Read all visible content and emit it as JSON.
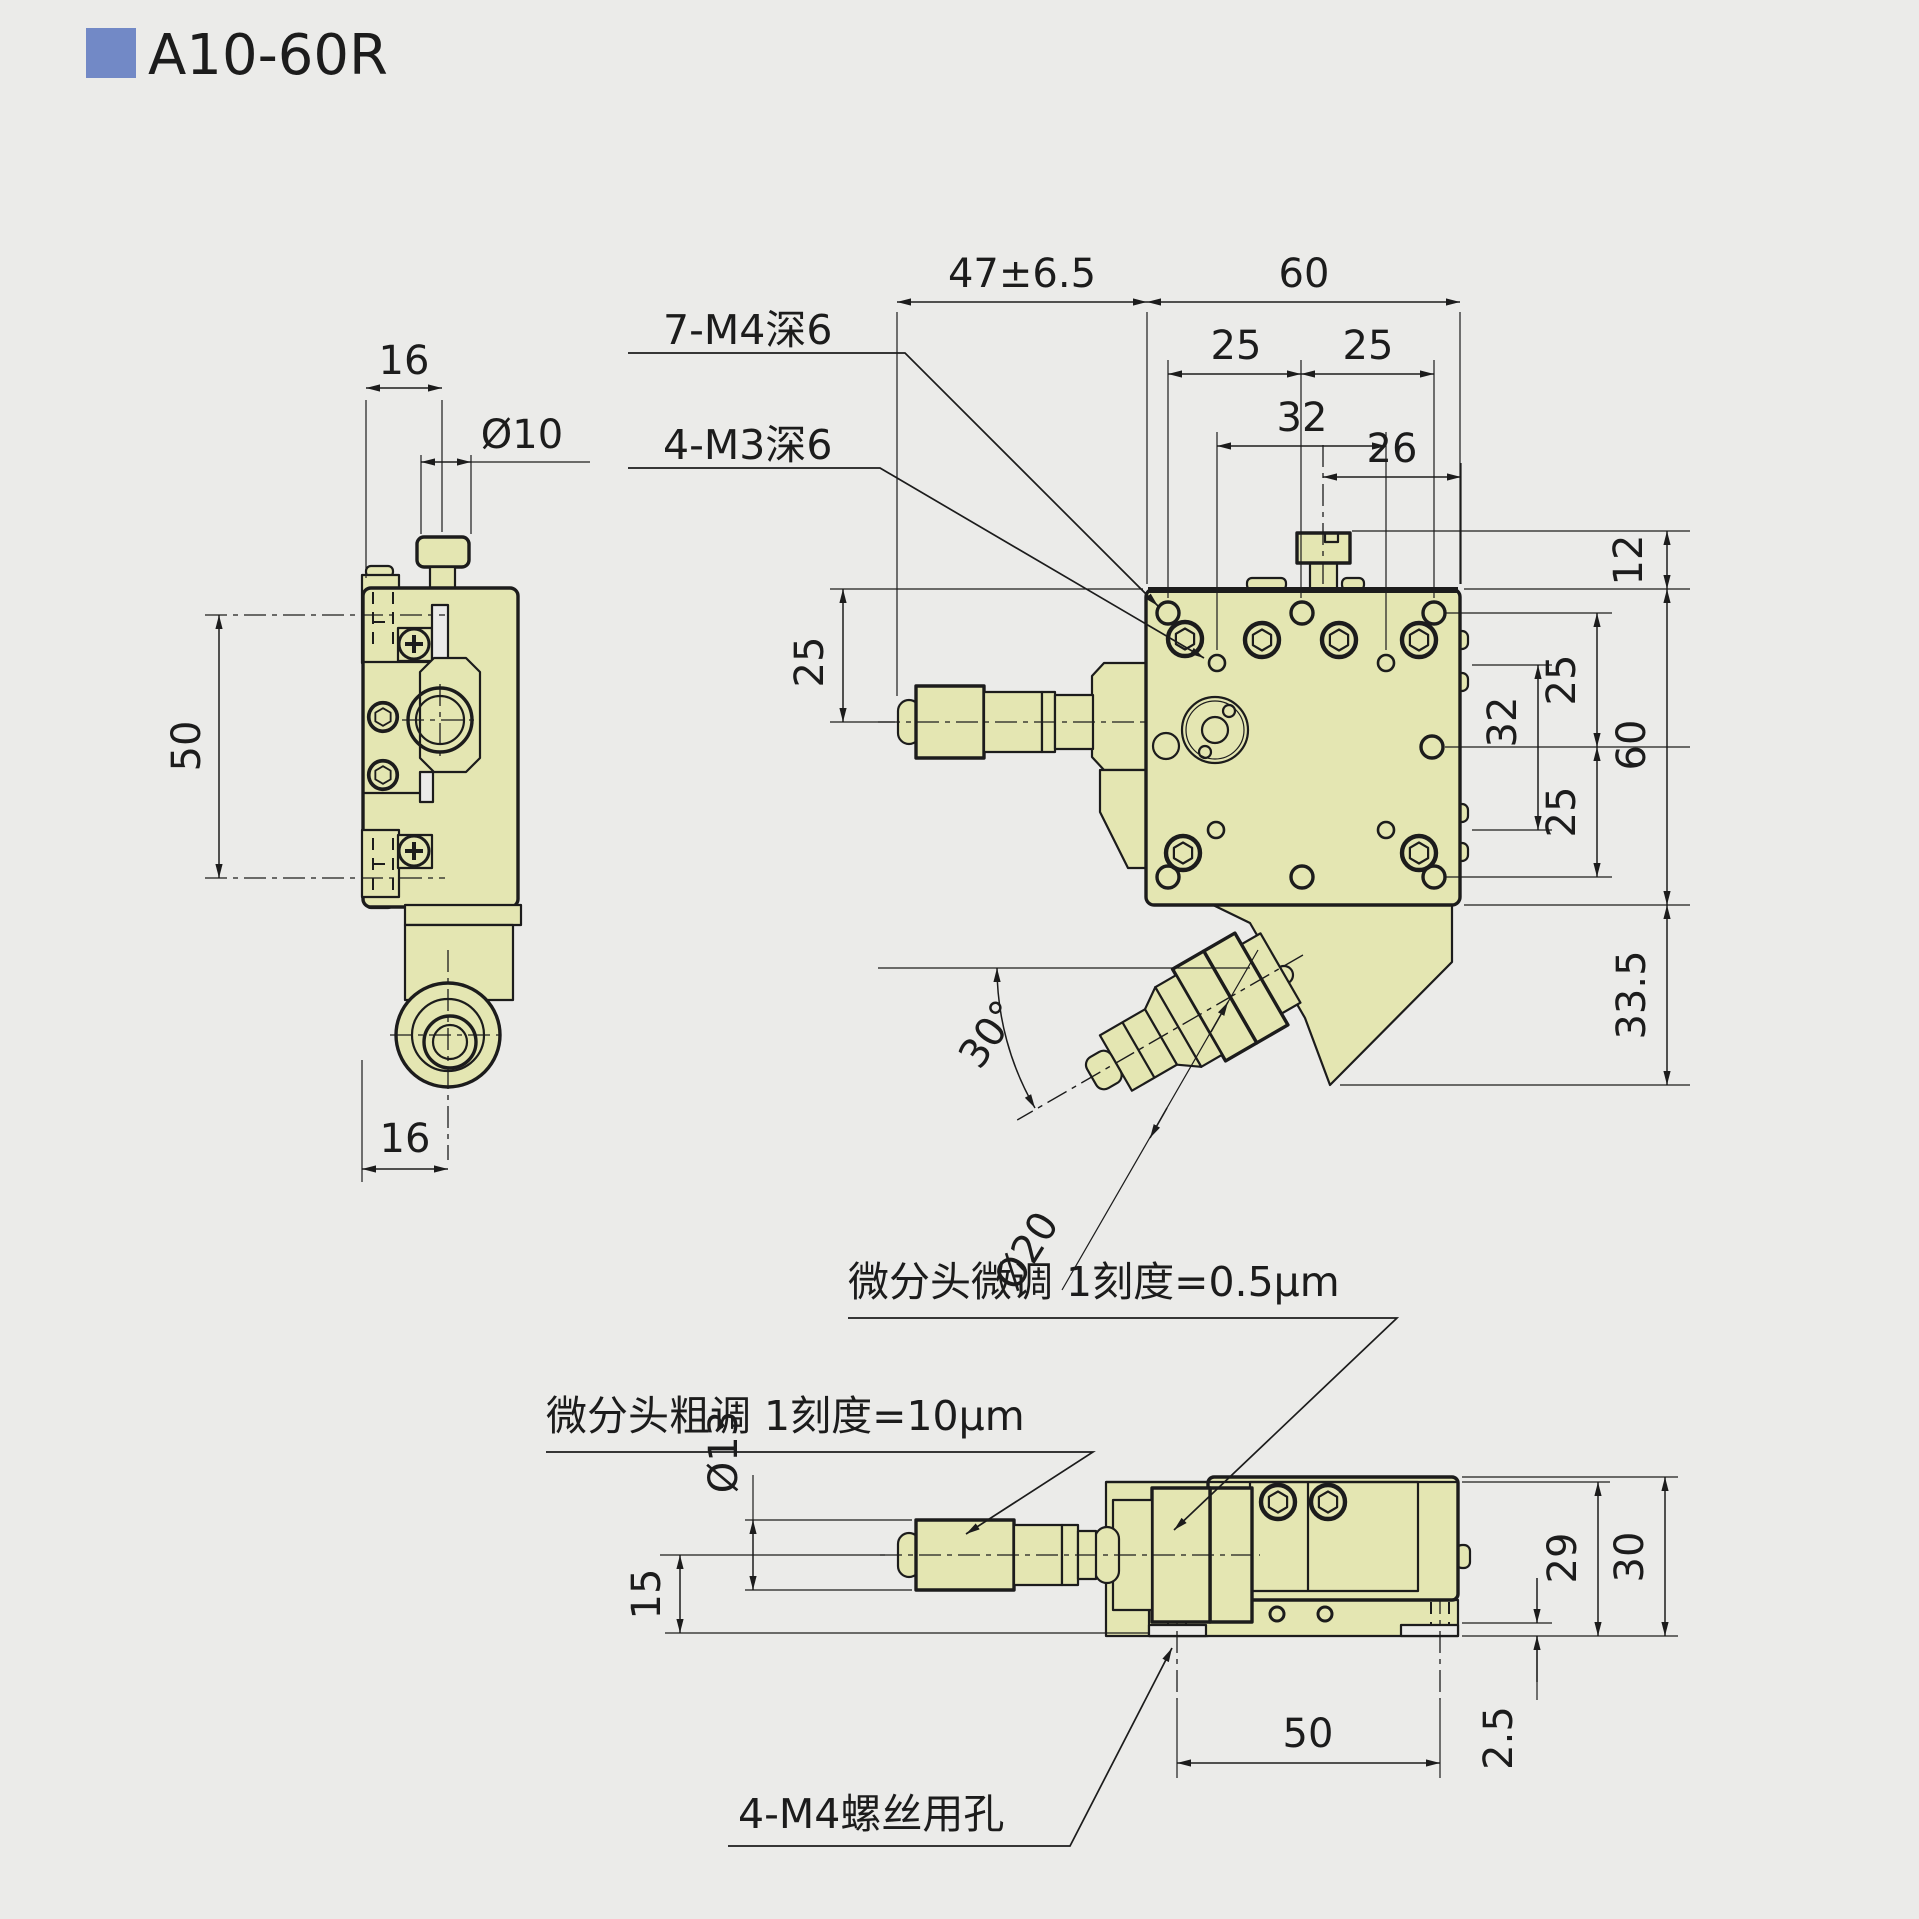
{
  "title": "A10-60R",
  "accent_color": "#7289c6",
  "colors": {
    "background": "#ebebe9",
    "body_fill": "#e4e6b2",
    "line": "#1c1c1c"
  },
  "side_view": {
    "dim_table_width": "16",
    "dim_knob_dia": "Ø10",
    "dim_clamp_span": "50",
    "dim_knob_center": "16"
  },
  "front_view": {
    "dim_travel": "47±6.5",
    "dim_width": "60",
    "dim_hole_left": "25",
    "dim_hole_right": "25",
    "dim_m3_span_top": "32",
    "dim_screw_offset": "26",
    "label_m4_holes": "7-M4深6",
    "label_m3_holes": "4-M3深6",
    "dim_axis_offset": "25",
    "dim_knob_height": "12",
    "dim_rows_top": "25",
    "dim_m3_span_right": "32",
    "dim_rows_bottom": "25",
    "dim_height": "60",
    "dim_lower_height": "33.5",
    "dim_angle": "30°",
    "dim_knob_dia": "Ø20"
  },
  "bottom_view": {
    "label_fine": "微分头微调 1刻度=0.5μm",
    "label_coarse": "微分头粗调 1刻度=10μm",
    "label_base_holes": "4-M4螺丝用孔",
    "dim_thimble_dia": "Ø13",
    "dim_axis_height": "15",
    "dim_block_height": "29",
    "dim_total_height": "30",
    "dim_base_step": "2.5",
    "dim_hole_span": "50"
  }
}
